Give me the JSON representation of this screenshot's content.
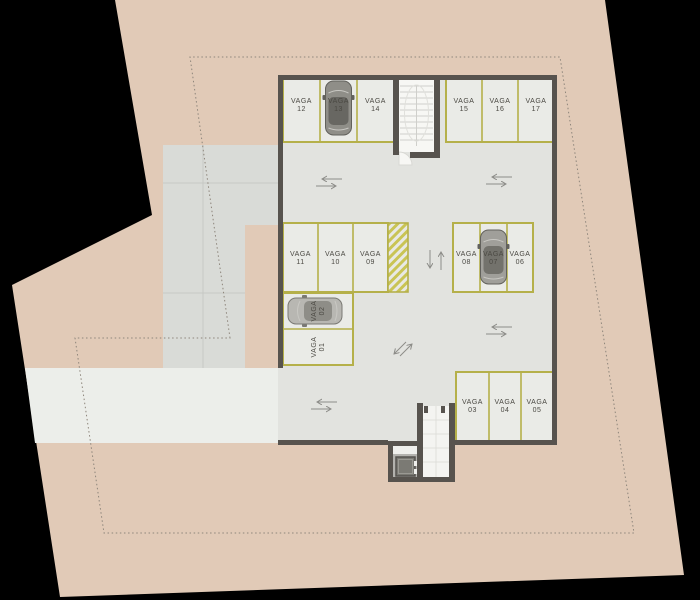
{
  "plan_type": "parking-garage-floor-plan",
  "colors": {
    "background": "#000000",
    "site_beige": "#e1cab7",
    "paving_gray": "#d9dbd7",
    "driveway_gray": "#eceeea",
    "garage_floor": "#e2e3df",
    "wall_dark": "#57534e",
    "stall_outline_yellow": "#b5b04a",
    "label_text": "#4b4943",
    "setback_dash": "#8d857b",
    "arrow_gray": "#8c8c88"
  },
  "stalls": [
    {
      "word": "VAGA",
      "number": "01"
    },
    {
      "word": "VAGA",
      "number": "02"
    },
    {
      "word": "VAGA",
      "number": "03"
    },
    {
      "word": "VAGA",
      "number": "04"
    },
    {
      "word": "VAGA",
      "number": "05"
    },
    {
      "word": "VAGA",
      "number": "06"
    },
    {
      "word": "VAGA",
      "number": "07"
    },
    {
      "word": "VAGA",
      "number": "08"
    },
    {
      "word": "VAGA",
      "number": "09"
    },
    {
      "word": "VAGA",
      "number": "10"
    },
    {
      "word": "VAGA",
      "number": "11"
    },
    {
      "word": "VAGA",
      "number": "12"
    },
    {
      "word": "VAGA",
      "number": "13"
    },
    {
      "word": "VAGA",
      "number": "14"
    },
    {
      "word": "VAGA",
      "number": "15"
    },
    {
      "word": "VAGA",
      "number": "16"
    },
    {
      "word": "VAGA",
      "number": "17"
    }
  ]
}
